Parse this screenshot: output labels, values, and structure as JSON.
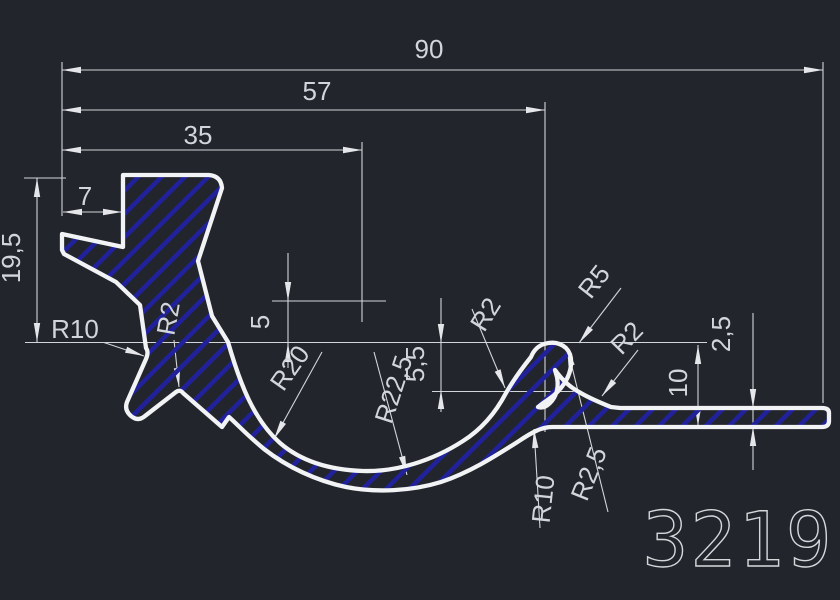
{
  "drawing": {
    "type": "cad-profile-cross-section",
    "part_number": "3219",
    "dimensions": {
      "overall_width": "90",
      "width_to_hook": "57",
      "width_to_head": "35",
      "head_offset": "7",
      "height_left": "19,5",
      "notch_depth": "5",
      "throat_depth": "5,5",
      "bar_height": "10",
      "bar_thickness": "2,5"
    },
    "radii": {
      "r10_left": "R10",
      "r2_neck": "R2",
      "r20_channel": "R20",
      "r22_5_channel": "R22,5",
      "r2_mid": "R2",
      "r5_hook": "R5",
      "r2_hook": "R2",
      "r2_5_web": "R2,5",
      "r10_bottom": "R10"
    }
  },
  "colors": {
    "background": "#22252b",
    "outline": "#f1f3f5",
    "dimension": "#d2d5da",
    "hatch": "#21219c"
  }
}
